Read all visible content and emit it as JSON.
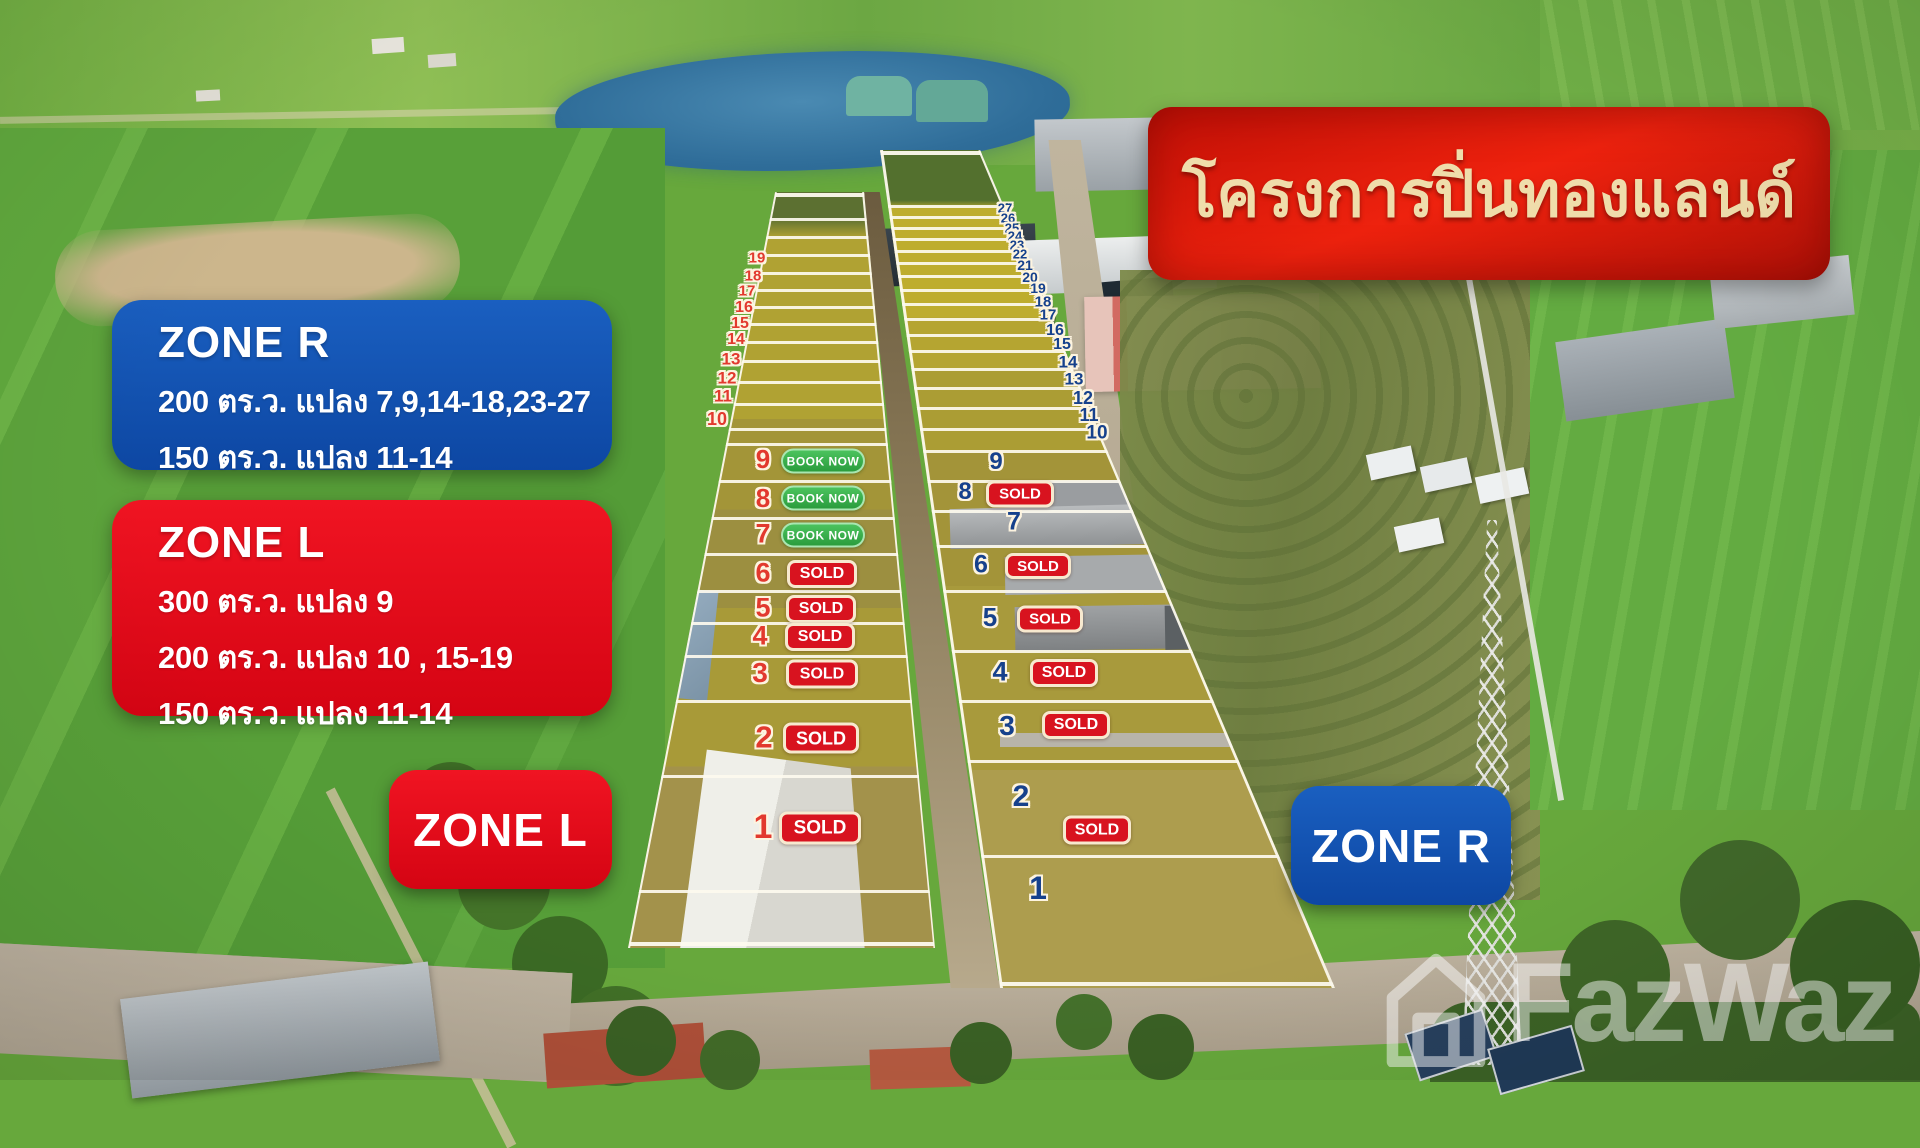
{
  "project": {
    "title": "โครงการปิ่นทองแลนด์"
  },
  "legend": {
    "zone_r": {
      "title": "ZONE R",
      "lines": [
        "200 ตร.ว. แปลง 7,9,14-18,23-27",
        "150 ตร.ว.  แปลง 11-14"
      ]
    },
    "zone_l": {
      "title": "ZONE L",
      "lines": [
        "300 ตร.ว. แปลง 9",
        "200 ตร.ว. แปลง 10 , 15-19",
        "150 ตร.ว.  แปลง 11-14"
      ]
    }
  },
  "zone_tags": {
    "left": "ZONE L",
    "right": "ZONE R"
  },
  "badges": {
    "sold": "SOLD",
    "book_now": "BOOK NOW"
  },
  "watermark": {
    "brand": "FazWaz"
  },
  "colors": {
    "title_banner_red": "#d51408",
    "title_text_cream": "#efddab",
    "zone_blue": "#1155b4",
    "zone_red": "#e50d1b",
    "sold_red": "#d8131f",
    "book_green": "#2fae44",
    "plot_number_red": "#e2392e",
    "plot_number_blue": "#16418c"
  },
  "plots": {
    "zone_l": [
      {
        "num": "19",
        "x": 757,
        "y": 258,
        "fs": 15
      },
      {
        "num": "18",
        "x": 753,
        "y": 276,
        "fs": 15
      },
      {
        "num": "17",
        "x": 747,
        "y": 291,
        "fs": 15
      },
      {
        "num": "16",
        "x": 744,
        "y": 308,
        "fs": 16
      },
      {
        "num": "15",
        "x": 740,
        "y": 324,
        "fs": 16
      },
      {
        "num": "14",
        "x": 736,
        "y": 340,
        "fs": 16
      },
      {
        "num": "13",
        "x": 731,
        "y": 359,
        "fs": 17
      },
      {
        "num": "12",
        "x": 727,
        "y": 378,
        "fs": 17
      },
      {
        "num": "11",
        "x": 723,
        "y": 396,
        "fs": 17
      },
      {
        "num": "10",
        "x": 717,
        "y": 419,
        "fs": 18
      },
      {
        "num": "9",
        "x": 763,
        "y": 459,
        "fs": 26,
        "badge": "book_now",
        "bx": 823,
        "by": 461,
        "bw": 80,
        "bh": 21,
        "bfs": 12
      },
      {
        "num": "8",
        "x": 763,
        "y": 498,
        "fs": 26,
        "badge": "book_now",
        "bx": 823,
        "by": 498,
        "bw": 80,
        "bh": 21,
        "bfs": 12
      },
      {
        "num": "7",
        "x": 763,
        "y": 534,
        "fs": 27,
        "badge": "book_now",
        "bx": 823,
        "by": 535,
        "bw": 80,
        "bh": 21,
        "bfs": 12
      },
      {
        "num": "6",
        "x": 763,
        "y": 573,
        "fs": 27,
        "badge": "sold",
        "bx": 822,
        "by": 574,
        "bw": 64,
        "bh": 22,
        "bfs": 16
      },
      {
        "num": "5",
        "x": 763,
        "y": 608,
        "fs": 27,
        "badge": "sold",
        "bx": 821,
        "by": 609,
        "bw": 64,
        "bh": 22,
        "bfs": 16
      },
      {
        "num": "4",
        "x": 760,
        "y": 636,
        "fs": 27,
        "badge": "sold",
        "bx": 820,
        "by": 637,
        "bw": 64,
        "bh": 22,
        "bfs": 16
      },
      {
        "num": "3",
        "x": 760,
        "y": 673,
        "fs": 28,
        "badge": "sold",
        "bx": 822,
        "by": 674,
        "bw": 66,
        "bh": 23,
        "bfs": 16
      },
      {
        "num": "2",
        "x": 764,
        "y": 737,
        "fs": 31,
        "badge": "sold",
        "bx": 821,
        "by": 738,
        "bw": 70,
        "bh": 25,
        "bfs": 18
      },
      {
        "num": "1",
        "x": 763,
        "y": 827,
        "fs": 34,
        "badge": "sold",
        "bx": 820,
        "by": 828,
        "bw": 76,
        "bh": 27,
        "bfs": 19
      }
    ],
    "zone_r": [
      {
        "num": "27",
        "x": 1005,
        "y": 208,
        "fs": 13
      },
      {
        "num": "26",
        "x": 1008,
        "y": 218,
        "fs": 13
      },
      {
        "num": "25",
        "x": 1012,
        "y": 228,
        "fs": 13
      },
      {
        "num": "24",
        "x": 1015,
        "y": 236,
        "fs": 13
      },
      {
        "num": "23",
        "x": 1017,
        "y": 245,
        "fs": 13
      },
      {
        "num": "22",
        "x": 1020,
        "y": 254,
        "fs": 13
      },
      {
        "num": "21",
        "x": 1025,
        "y": 265,
        "fs": 14
      },
      {
        "num": "20",
        "x": 1030,
        "y": 277,
        "fs": 14
      },
      {
        "num": "19",
        "x": 1038,
        "y": 288,
        "fs": 14
      },
      {
        "num": "18",
        "x": 1043,
        "y": 302,
        "fs": 15
      },
      {
        "num": "17",
        "x": 1048,
        "y": 315,
        "fs": 15
      },
      {
        "num": "16",
        "x": 1055,
        "y": 331,
        "fs": 16
      },
      {
        "num": "15",
        "x": 1062,
        "y": 345,
        "fs": 16
      },
      {
        "num": "14",
        "x": 1068,
        "y": 362,
        "fs": 17
      },
      {
        "num": "13",
        "x": 1074,
        "y": 379,
        "fs": 17
      },
      {
        "num": "12",
        "x": 1083,
        "y": 398,
        "fs": 18
      },
      {
        "num": "11",
        "x": 1089,
        "y": 415,
        "fs": 18
      },
      {
        "num": "10",
        "x": 1097,
        "y": 433,
        "fs": 19
      },
      {
        "num": "9",
        "x": 996,
        "y": 462,
        "fs": 24
      },
      {
        "num": "8",
        "x": 965,
        "y": 492,
        "fs": 24,
        "badge": "sold",
        "bx": 1020,
        "by": 494,
        "bw": 62,
        "bh": 21,
        "bfs": 15
      },
      {
        "num": "7",
        "x": 1014,
        "y": 522,
        "fs": 25
      },
      {
        "num": "6",
        "x": 981,
        "y": 565,
        "fs": 25,
        "badge": "sold",
        "bx": 1038,
        "by": 566,
        "bw": 60,
        "bh": 20,
        "bfs": 15
      },
      {
        "num": "5",
        "x": 990,
        "y": 617,
        "fs": 26,
        "badge": "sold",
        "bx": 1050,
        "by": 619,
        "bw": 60,
        "bh": 21,
        "bfs": 15
      },
      {
        "num": "4",
        "x": 1000,
        "y": 672,
        "fs": 27,
        "badge": "sold",
        "bx": 1064,
        "by": 673,
        "bw": 62,
        "bh": 22,
        "bfs": 16
      },
      {
        "num": "3",
        "x": 1007,
        "y": 726,
        "fs": 28,
        "badge": "sold",
        "bx": 1076,
        "by": 725,
        "bw": 62,
        "bh": 22,
        "bfs": 16
      },
      {
        "num": "2",
        "x": 1021,
        "y": 797,
        "fs": 30,
        "badge": "sold",
        "bx": 1097,
        "by": 830,
        "bw": 62,
        "bh": 23,
        "bfs": 16
      },
      {
        "num": "1",
        "x": 1038,
        "y": 888,
        "fs": 32
      }
    ]
  }
}
